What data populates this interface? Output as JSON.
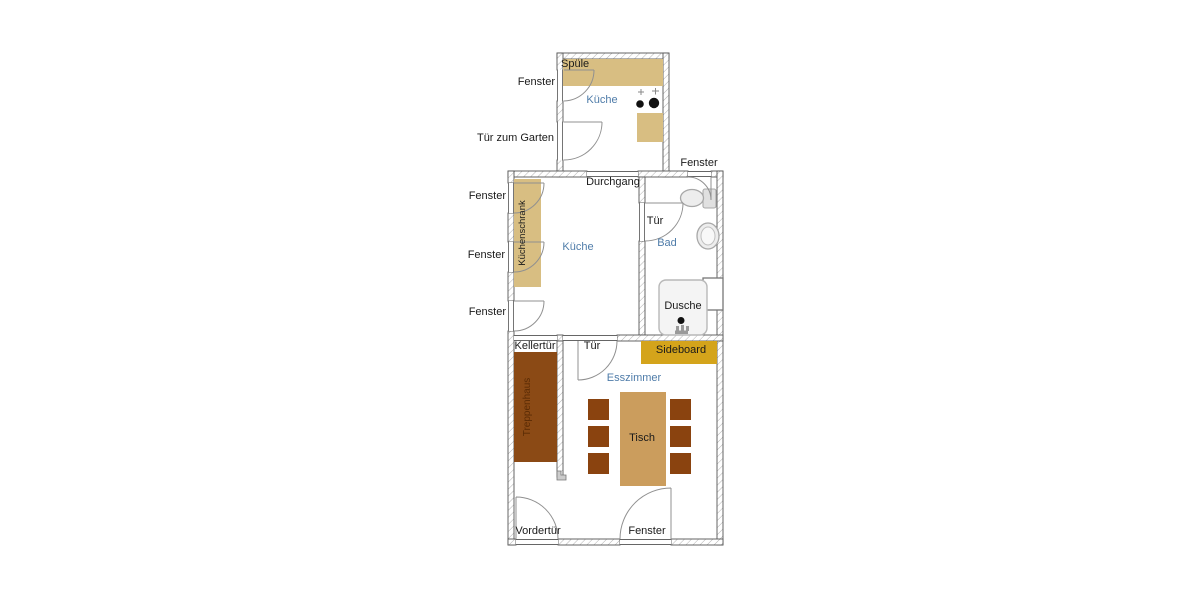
{
  "plan": {
    "top_kitchen": {
      "room_label": "Küche",
      "sink_label": "Spüle",
      "window_label": "Fenster",
      "garden_door_label": "Tür zum Garten"
    },
    "middle_kitchen": {
      "room_label": "Küche",
      "passage_label": "Durchgang",
      "cabinet_label": "Küchenschrank",
      "window_labels": [
        "Fenster",
        "Fenster",
        "Fenster"
      ]
    },
    "bathroom": {
      "room_label": "Bad",
      "door_label": "Tür",
      "window_label": "Fenster",
      "shower_label": "Dusche"
    },
    "dining_room": {
      "room_label": "Esszimmer",
      "cellar_door_label": "Kellertür",
      "stairwell_label": "Treppenhaus",
      "door_label": "Tür",
      "sideboard_label": "Sideboard",
      "table_label": "Tisch",
      "front_door_label": "Vordertür",
      "window_label": "Fenster"
    }
  },
  "colors": {
    "counter": "#D8BE82",
    "stairwell": "#8B4A15",
    "stairwell_text": "#5a2b05",
    "chair": "#8A430F",
    "table": "#CB9D5D",
    "sideboard": "#D4A41B",
    "room_label": "#4f7ca9",
    "label": "#1a1a1a",
    "wall_outline": "#555555",
    "hatch_line": "#a8a8a8",
    "swing_line": "#909090",
    "fixture_fill": "#ededed",
    "fixture_stroke": "#a8a8a8"
  }
}
